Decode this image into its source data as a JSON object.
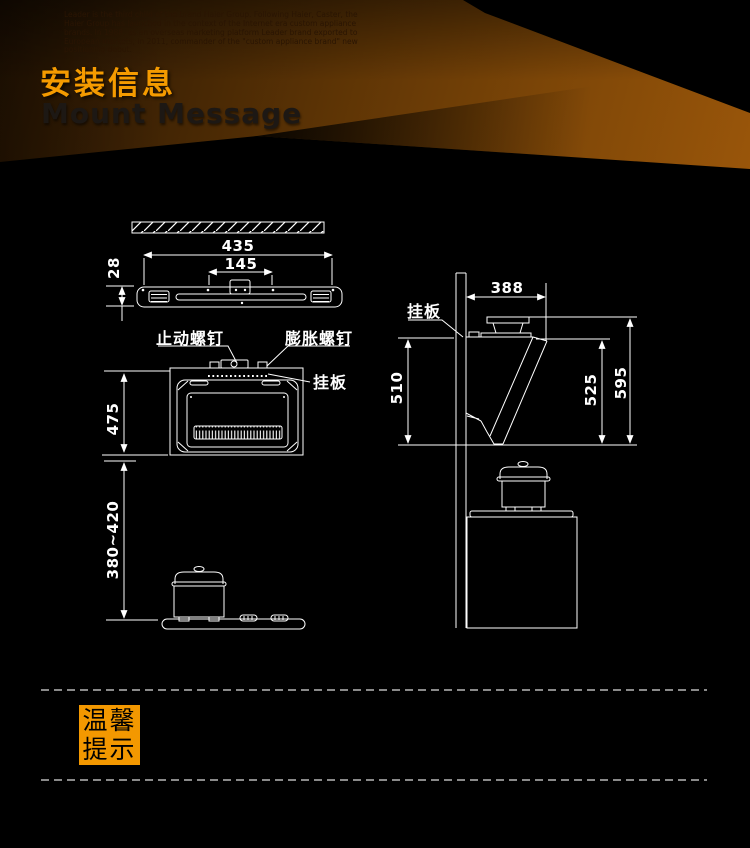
{
  "header": {
    "intro_text": "Leader is the third child of the brand Haier Group. Following Haier, Caster, the Haier Group has launched in the context of the Internet era custom appliance brands. In 1988, as an overseas marketing platform Leader brand exported to European markets, in 2011, commander of the \"custom appliance brand\" new positioning debut.",
    "title_cn": "安装信息",
    "title_en": "Mount Message"
  },
  "diagram": {
    "dimensions": {
      "plate_width": "435",
      "plate_hole_span": "145",
      "plate_height": "28",
      "hood_height": "475",
      "hood_to_stove": "380~420",
      "depth": "388",
      "back_height": "510",
      "front_height": "525",
      "total_height": "595"
    },
    "labels": {
      "stop_screw": "止动螺钉",
      "expansion_screw": "膨胀螺钉",
      "hanging_plate_front": "挂板",
      "hanging_plate_side": "挂板"
    }
  },
  "tips": {
    "line1": "温馨",
    "line2": "提示"
  },
  "colors": {
    "accent_orange": "#f59b00",
    "tip_box_orange": "#f39800",
    "drawing_line": "#ffffff",
    "dashed_gray": "#8a8a8a"
  }
}
